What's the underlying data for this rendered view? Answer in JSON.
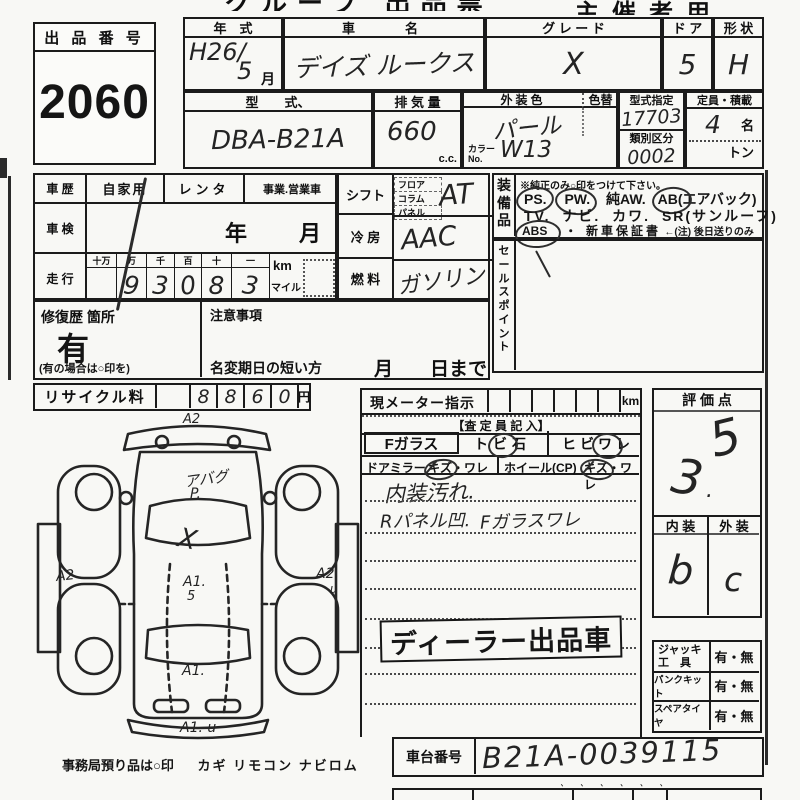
{
  "banner": {
    "title_fragment": "グループ 出品票",
    "right_label": "主催者用"
  },
  "lot": {
    "label": "出 品 番 号",
    "number": "2060"
  },
  "row1": {
    "year_label": "年　式",
    "year_line1": "H26/",
    "year_line2": "5",
    "month_unit": "月",
    "name_label": "車　　名",
    "name_value": "デイズ ルークス",
    "grade_label": "グ レ ー ド",
    "grade_value": "X",
    "door_label": "ド ア",
    "door_value": "5",
    "shape_label": "形 状",
    "shape_value": "H"
  },
  "row2": {
    "model_label": "型　　式、",
    "model_value": "DBA-B21A",
    "disp_label": "排 気 量",
    "disp_value": "660",
    "disp_unit": "c.c.",
    "color_label": "外装色",
    "color_change_label": "色替",
    "color_value": "パール",
    "color_no_label": "カラーNo.",
    "color_no_value": "W13",
    "type_label": "型式指定",
    "type_value": "17703",
    "class_label": "類別区分",
    "class_value": "0002",
    "cap_label": "定員・積載",
    "cap_value": "4",
    "cap_unit": "名",
    "ton_label": "トン"
  },
  "history": {
    "label": "車 歴",
    "opt1": "自家用",
    "opt2": "レンタ",
    "opt3": "事業.営業車"
  },
  "shaken": {
    "label": "車 検",
    "year_unit": "年",
    "month_unit": "月"
  },
  "mileage": {
    "label": "走 行",
    "headers": [
      "十万",
      "万",
      "千",
      "百",
      "十",
      "一"
    ],
    "digits": [
      "",
      "9",
      "3",
      "0",
      "8",
      "3"
    ],
    "unit_km": "km",
    "unit_mile": "マイル"
  },
  "repair": {
    "label": "修復歴 箇所",
    "value": "有",
    "note": "(有の場合は○印を)"
  },
  "caution": {
    "label": "注意事項",
    "deadline_label": "名変期日の短い方",
    "month_unit": "月",
    "day_unit": "日まで"
  },
  "shift": {
    "label": "シフト",
    "opts": [
      "フロア",
      "コラム",
      "パネル"
    ],
    "value": "AT"
  },
  "ac": {
    "label": "冷 房",
    "value": "AAC"
  },
  "fuel": {
    "label": "燃 料",
    "value": "ガソリン"
  },
  "equipment": {
    "label": "装備品",
    "note": "※純正のみ○印をつけて下さい。",
    "ps": "PS.",
    "pw": "PW.",
    "aw": "純AW.",
    "ab": "AB",
    "ab_rest": "(エアバック)",
    "tv": "TV.",
    "navi": "ナビ.",
    "kawa": "カワ.",
    "sr": "SR(サンルーフ)",
    "abs": "ABS",
    "cert": "・ 新車保証書",
    "cert_note": "←(注) 後日送りのみ"
  },
  "sales_point": {
    "label": "セールスポイント"
  },
  "recycle": {
    "label": "リサイクル料",
    "digits": [
      "8",
      "8",
      "6",
      "0"
    ],
    "unit": "円"
  },
  "diagram": {
    "top": "A2",
    "hood_line1": "アバグ",
    "hood_line2": "P.",
    "windshield_mark": "X",
    "center_line1": "A1.",
    "center_line2": "5",
    "left": "A2",
    "right_line1": "A2.",
    "right_line2": "u",
    "bottom": "A1.",
    "below": "A1. u",
    "office_note": "事務局預り品は○印",
    "office_items": "カギ リモコン ナビロム"
  },
  "meter": {
    "label": "現メーター指示",
    "unit": "km"
  },
  "assessor": {
    "header": "【査 定 員 記 入】",
    "fglass": "Fガラス",
    "stone": [
      "ト",
      "ビ",
      "石"
    ],
    "crack": [
      "ヒ",
      "ビ",
      "ワ",
      "レ"
    ],
    "mirror_label": "ドアミラー",
    "mirror_kizu": "キズ",
    "mirror_ware": "・ワレ",
    "wheel_label": "ホイール(CP)",
    "wheel_kizu": "キズ",
    "wheel_ware": "・ワレ",
    "note1": "内装汚れ.",
    "note2a": "Rパネル凹.",
    "note2b": "Fガラスワレ"
  },
  "stamp": {
    "text": "ディーラー出品車"
  },
  "score": {
    "label": "評 価 点",
    "digit1": "3",
    "dot": ".",
    "digit2": "5",
    "interior_label": "内 装",
    "exterior_label": "外 装",
    "interior": "b",
    "exterior": "c"
  },
  "tools": {
    "r1_label": "ジャッキ",
    "r1_label2": "工　具",
    "r1_value": "有・無",
    "r2_label": "パンクキット",
    "r2_value": "有・無",
    "r3_label": "スペアタイヤ",
    "r3_value": "有・無"
  },
  "chassis": {
    "label": "車台番号",
    "value": "B21A-0039115",
    "ticks": "、 、 、 、 、 、"
  }
}
